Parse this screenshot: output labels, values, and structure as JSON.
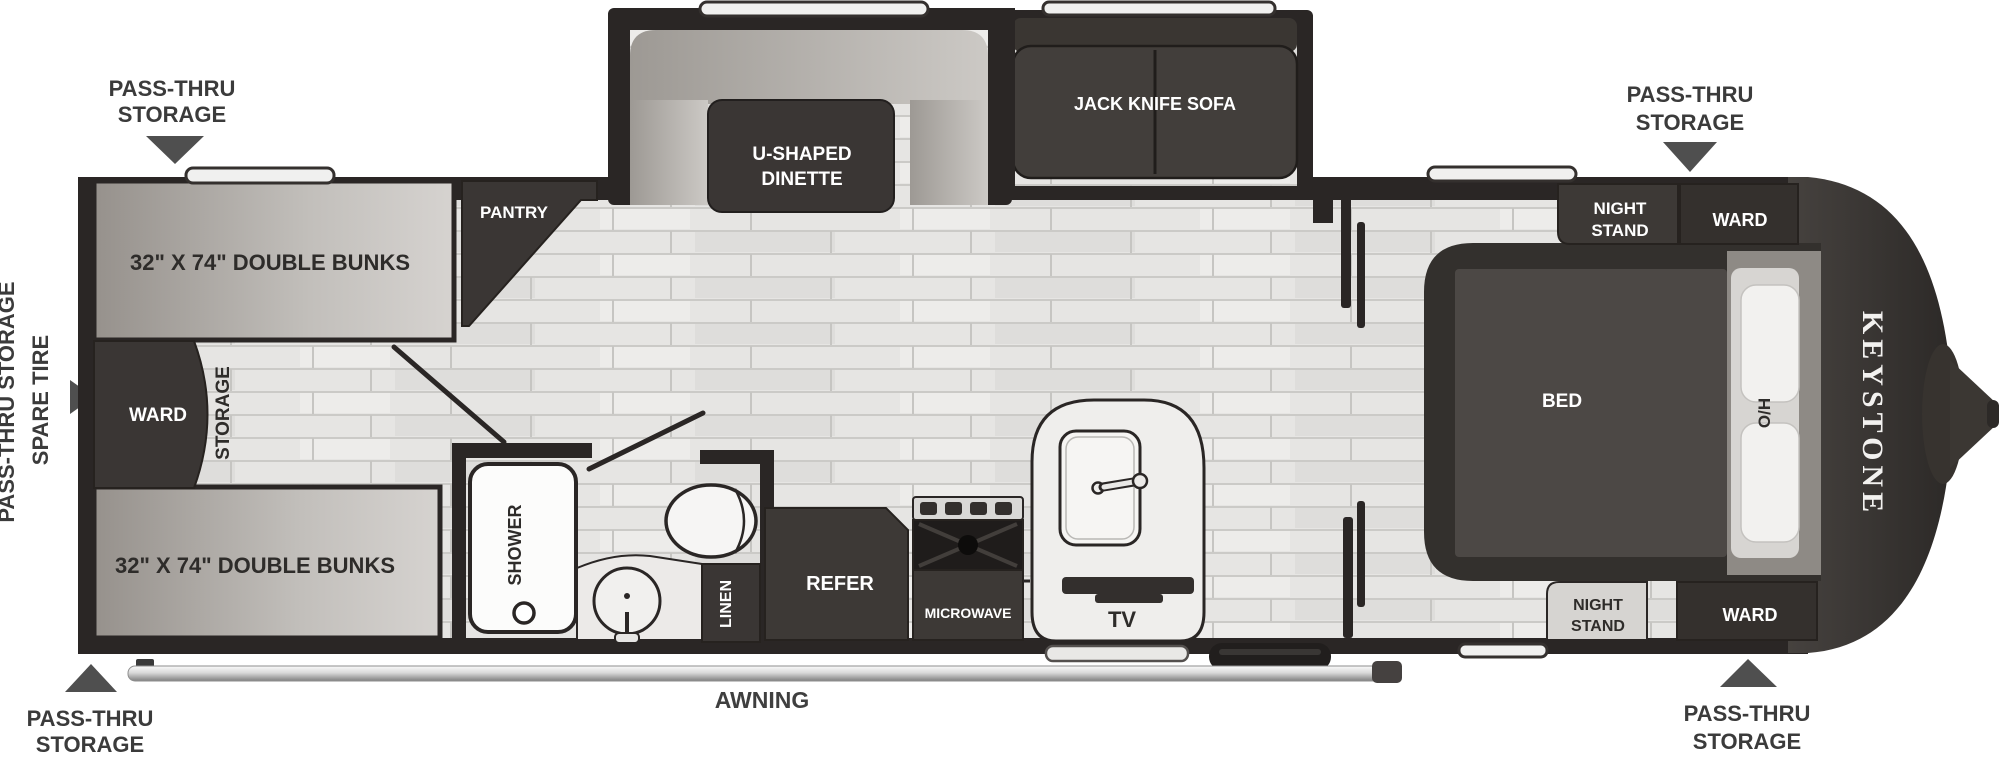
{
  "title": "Keystone travel trailer floor plan",
  "brand": "KEYSTONE",
  "colors": {
    "wall": "#2a2625",
    "furniture_dark": "#3d3936",
    "floor": "#e6e5e3",
    "bunk_gray": "#b4b0ac",
    "white_fixture": "#f4f3f1"
  },
  "callouts": {
    "pass_thru_line1": "PASS-THRU",
    "pass_thru_line2": "STORAGE",
    "left_pass_thru": "PASS-THRU STORAGE",
    "spare_tire": "SPARE TIRE"
  },
  "labels": {
    "bunk_top": "32\" X 74\" DOUBLE BUNKS",
    "bunk_bottom": "32\" X 74\" DOUBLE BUNKS",
    "ward_left": "WARD",
    "storage": "STORAGE",
    "pantry": "PANTRY",
    "dinette_line1": "U-SHAPED",
    "dinette_line2": "DINETTE",
    "sofa": "JACK KNIFE SOFA",
    "shower": "SHOWER",
    "linen": "LINEN",
    "refer": "REFER",
    "microwave": "MICROWAVE",
    "tv": "TV",
    "bed": "BED",
    "overhead": "O/H",
    "night_stand_line1": "NIGHT",
    "night_stand_line2": "STAND",
    "ward_bedroom_top": "WARD",
    "ward_bedroom_bottom": "WARD",
    "awning": "AWNING"
  }
}
